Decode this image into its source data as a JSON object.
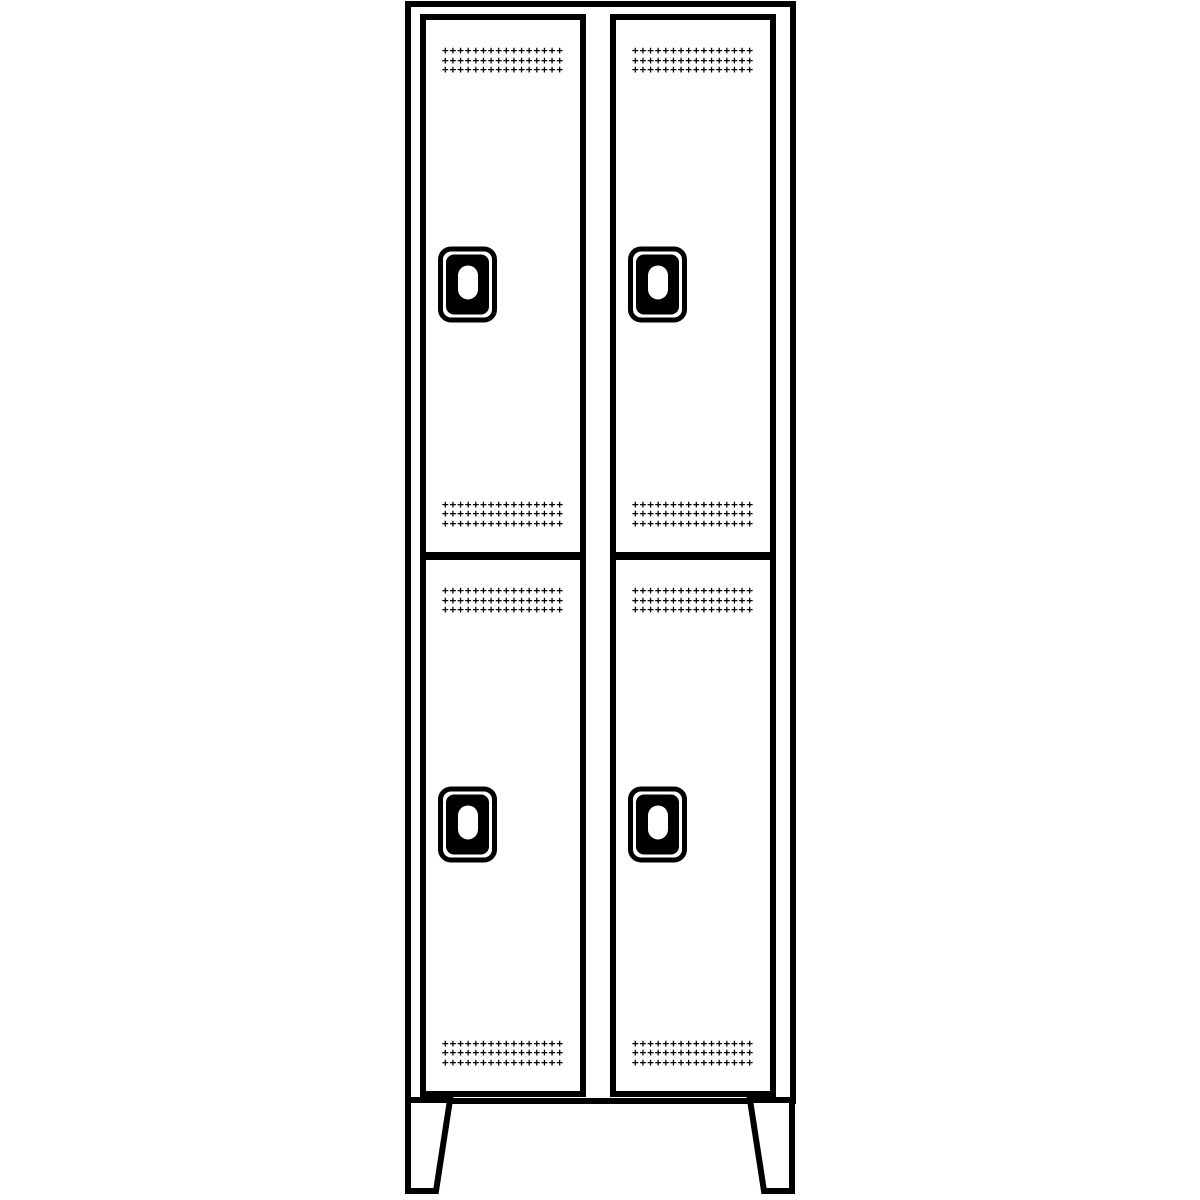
{
  "illustration": {
    "description": "Line drawing of a double-tier cloakroom locker with feet",
    "background_color": "#ffffff",
    "line_color": "#000000",
    "cabinet": {
      "columns": 2,
      "tiers": 2,
      "door_count": 4,
      "feet_count": 2
    },
    "doors": [
      {
        "id": "top-left",
        "position": "top left"
      },
      {
        "id": "top-right",
        "position": "top right"
      },
      {
        "id": "bottom-left",
        "position": "bottom left"
      },
      {
        "id": "bottom-right",
        "position": "bottom right"
      }
    ],
    "door_features": {
      "vent_bands_per_door": 2,
      "perforation": {
        "rows": 3,
        "cols": 16,
        "glyph": "+"
      },
      "handle": {
        "type": "recessed grip",
        "fill": "#000000",
        "slot_color": "#ffffff"
      }
    }
  }
}
